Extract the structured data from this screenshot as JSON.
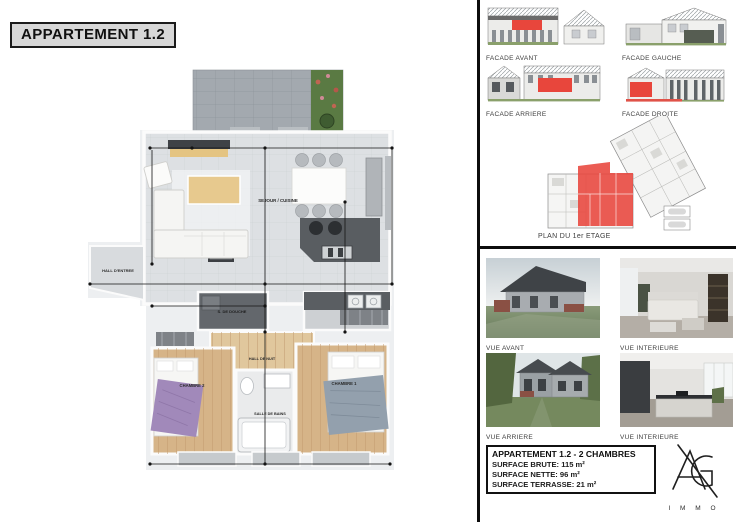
{
  "header": {
    "title": "APPARTEMENT 1.2"
  },
  "floorplan": {
    "rooms": {
      "sejour_cuisine": "SEJOUR / CUISINE",
      "hall_entree": "HALL D'ENTREE",
      "s_de_douche": "S. DE DOUCHE",
      "hall_de_nuit": "HALL DE NUIT",
      "chambre_2": "CHAMBRE 2",
      "salle_de_bains": "SALLE DE BAINS",
      "chambre_1": "CHAMBRE 1"
    }
  },
  "elevations": {
    "facade_avant": "FACADE AVANT",
    "facade_gauche": "FACADE GAUCHE",
    "facade_arriere": "FACADE ARRIERE",
    "facade_droite": "FACADE DROITE",
    "plan_etage_label": "PLAN DU 1er ETAGE"
  },
  "photos": {
    "vue_avant": "VUE AVANT",
    "vue_interieure_salon": "VUE INTERIEURE",
    "vue_arriere": "VUE ARRIERE",
    "vue_interieure_cuisine": "VUE INTERIEURE"
  },
  "summary": {
    "title": "APPARTEMENT 1.2  -  2 CHAMBRES",
    "surface_brute": "SURFACE BRUTE: 115 m²",
    "surface_nette": "SURFACE NETTE: 96 m²",
    "surface_terrasse": "SURFACE TERRASSE: 21 m²"
  },
  "logo": {
    "monogram": "AG",
    "wordmark": "I M M O"
  },
  "colors": {
    "highlight_red": "#e8463c",
    "plan_floor": "#dde0e3",
    "wood_floor": "#d6b488",
    "terrace_gray": "#a3a9af"
  }
}
